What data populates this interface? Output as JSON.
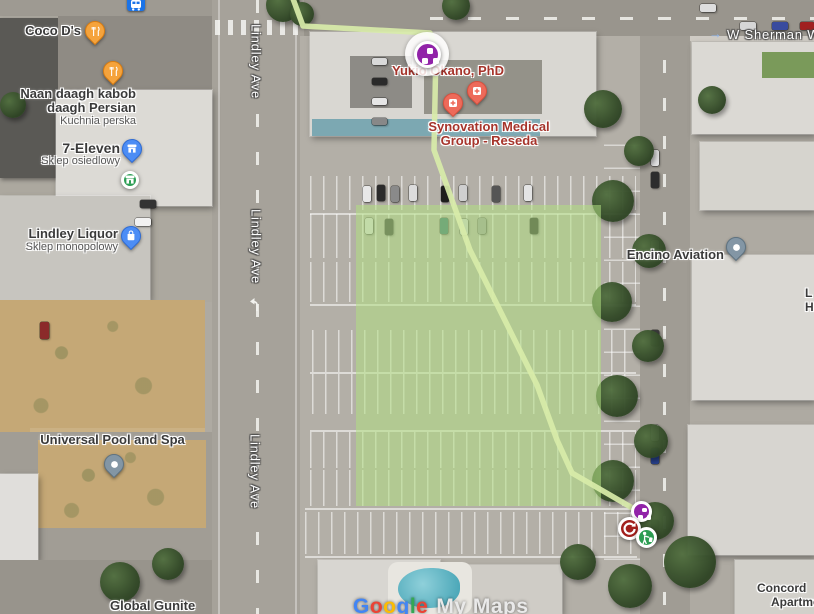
{
  "colors": {
    "marker_purple": "#9123A8",
    "marker_red_circle": "#A2201D",
    "marker_green_circle": "#2C9C51",
    "pin_orange": "#F5A33C",
    "pin_blue": "#4C8DF5",
    "pin_slate": "#8396A5",
    "pin_coral": "#ED6A5A",
    "medical_label": "#A6342B",
    "route_green": "#D8ECA9",
    "zone_green": "rgba(176,222,130,0.55)",
    "transit_blue": "#1A73E8"
  },
  "streets": {
    "lindley": [
      "Lindley Ave",
      "Lindley Ave",
      "Lindley Ave"
    ],
    "sherman": "W Sherman Way"
  },
  "places": {
    "coco": {
      "label": "Coco D's"
    },
    "naan": {
      "line1": "Naan daagh kabob",
      "line2": "daagh Persian",
      "sub": "Kuchnia perska"
    },
    "seven": {
      "label": "7-Eleven",
      "sub": "Sklep osiedlowy"
    },
    "liquor": {
      "label": "Lindley Liquor",
      "sub": "Sklep monopolowy"
    },
    "pool": {
      "label": "Universal Pool and Spa"
    },
    "gunite": {
      "label": "Global Gunite"
    },
    "yukio": {
      "label": "Yukio Okano, PhD"
    },
    "synovation": {
      "line1": "Synovation Medical",
      "line2": "Group - Reseda"
    },
    "encino": {
      "label": "Encino Aviation"
    },
    "concord": {
      "line1": "Concord",
      "line2": "Apartments"
    },
    "edge_clipped": {
      "line1": "L",
      "line2": "H"
    }
  },
  "watermark": {
    "word": "Google",
    "letter_colors": [
      "#4285F4",
      "#EA4335",
      "#FBBC05",
      "#4285F4",
      "#34A853",
      "#EA4335"
    ],
    "suffix": "My Maps"
  }
}
